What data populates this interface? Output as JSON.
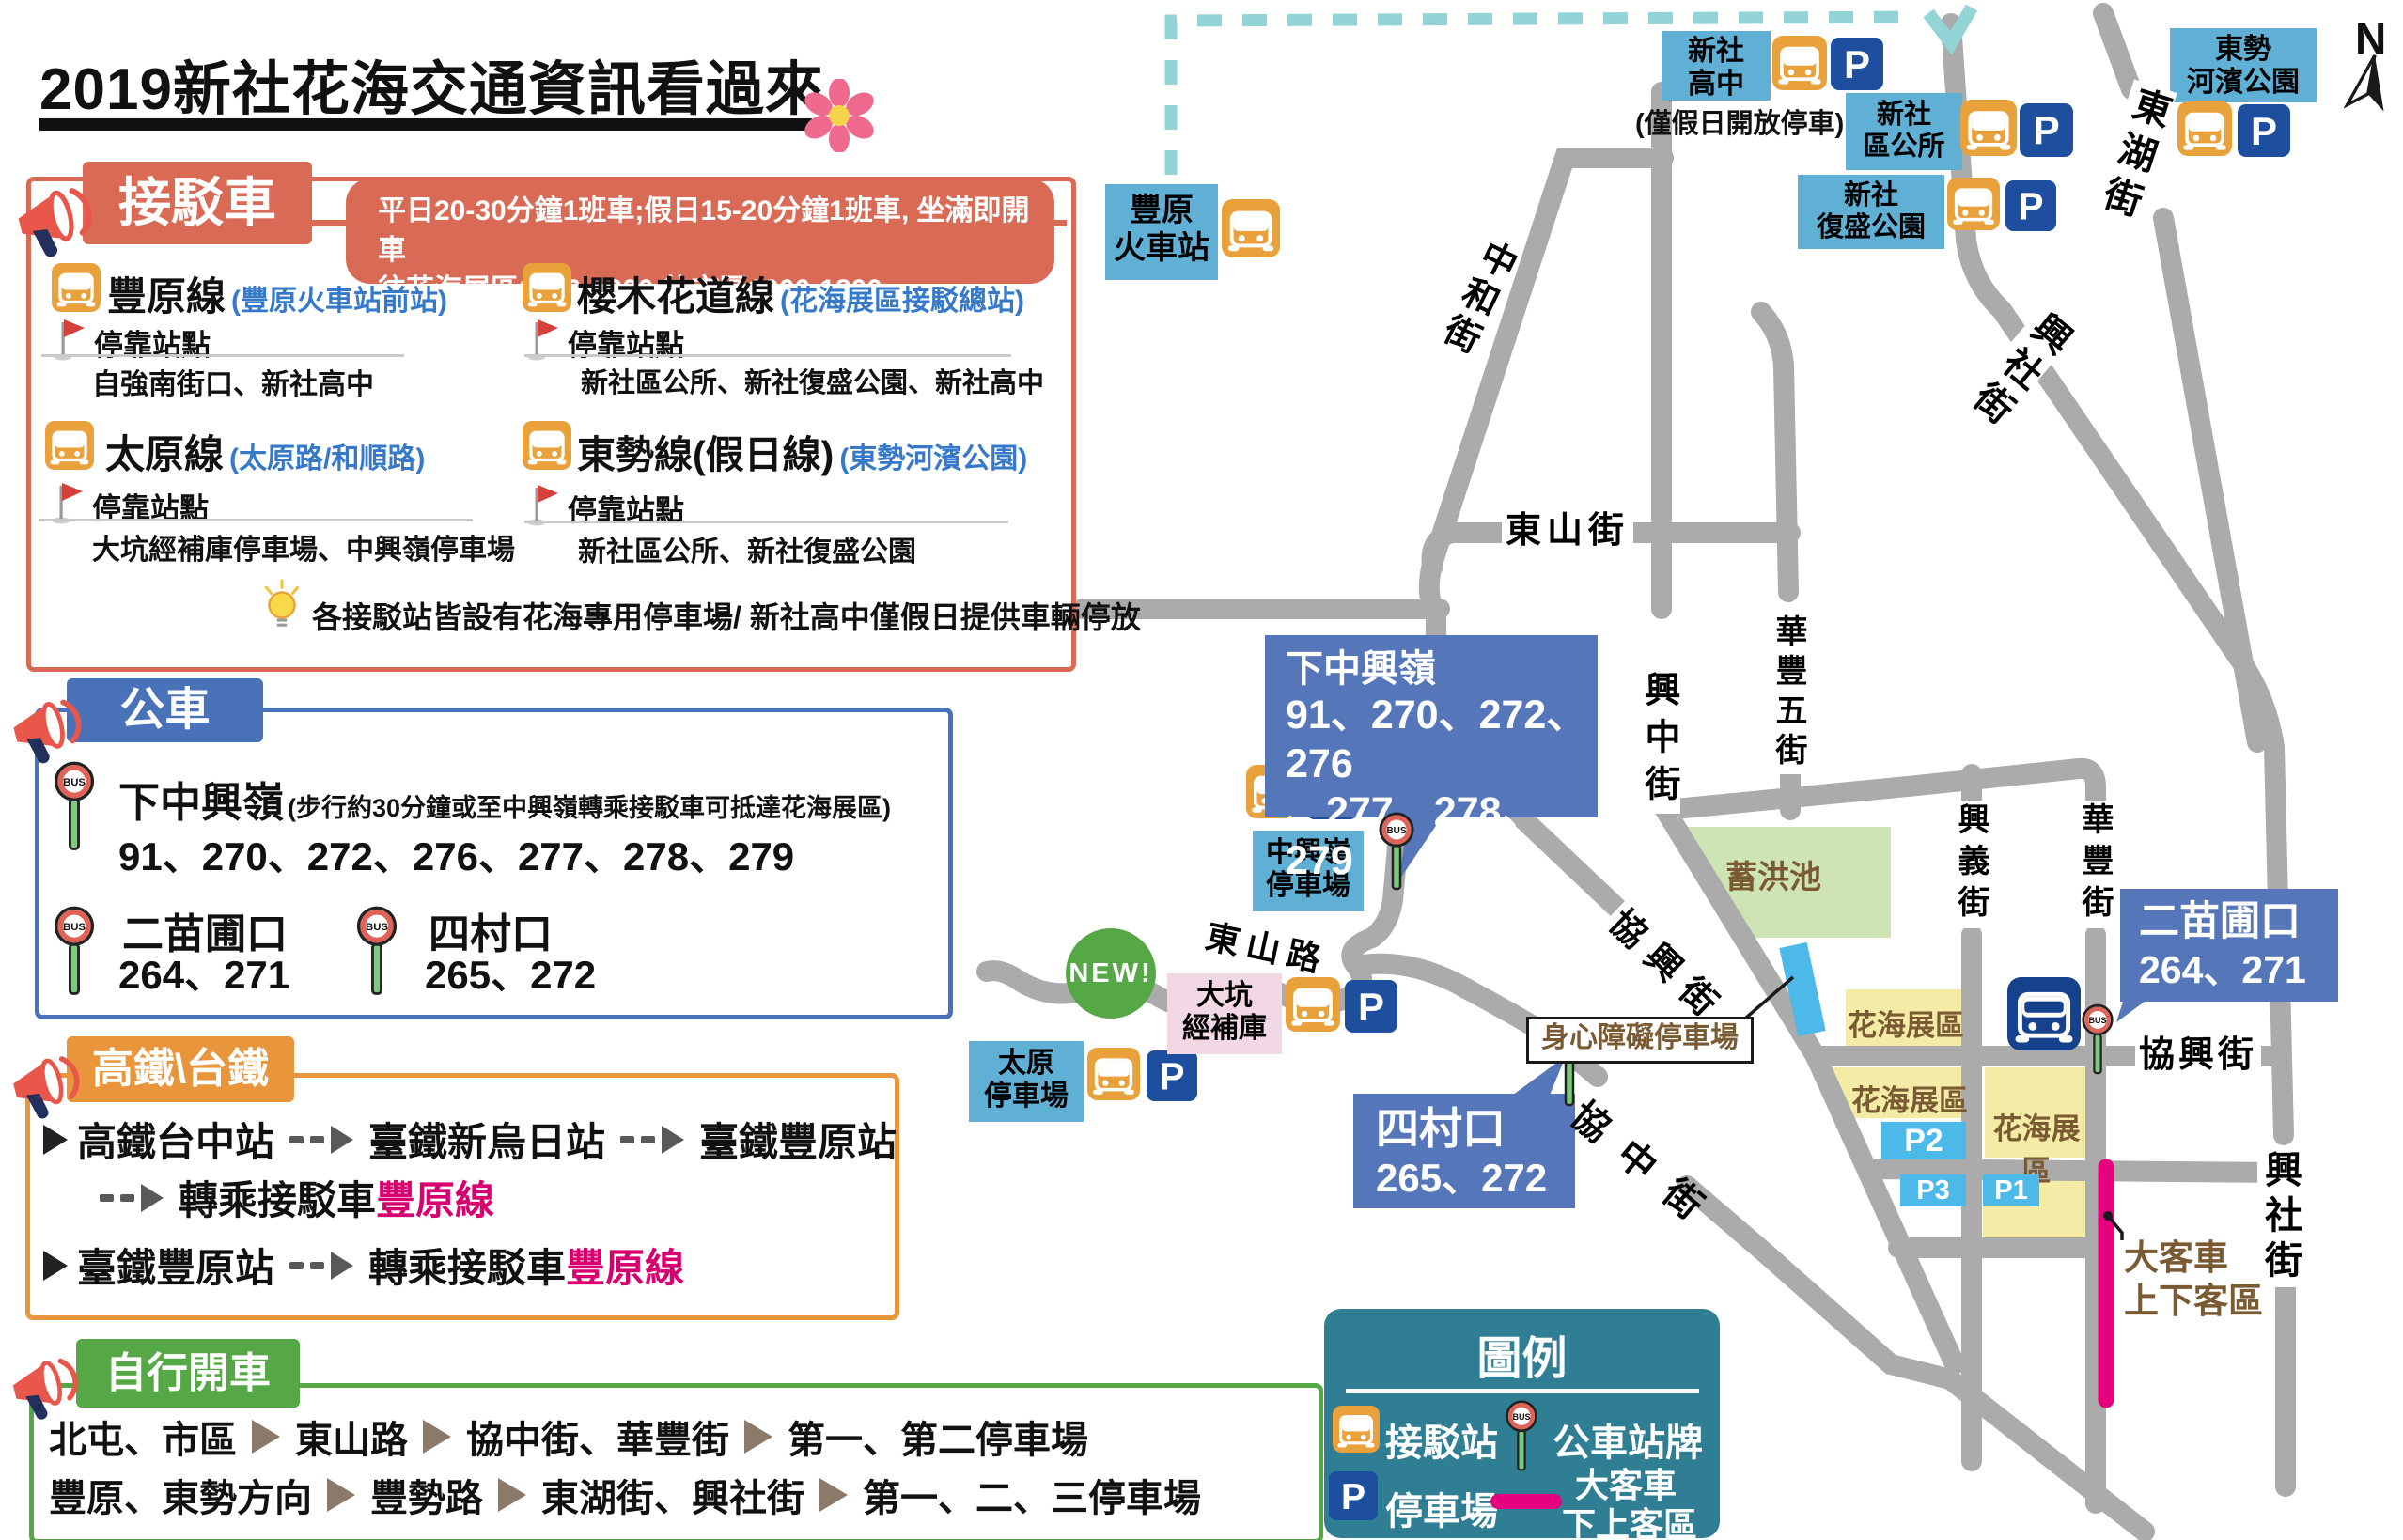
{
  "title": "2019新社花海交通資訊看過來",
  "colors": {
    "accent_red": "#d96a55",
    "panel_blue": "#4a72b8",
    "station_blue": "#5fb0d4",
    "orange": "#e8953b",
    "green": "#55a845",
    "legend_teal": "#2f7e93",
    "magenta": "#e5007e",
    "road_grey": "#ababab",
    "route_dash_teal": "#93d4d6",
    "bus_icon_orange": "#e9a23b",
    "parking_navy": "#1d4f9e",
    "expo_yellow": "#f4eba6",
    "p_cyan": "#4cb9e8",
    "pond_green": "#cfe4b4",
    "text_brown": "#7a5a33"
  },
  "panels": {
    "shuttle": {
      "header": "接駁車",
      "note_line1": "平日20-30分鐘1班車;假日15-20分鐘1班車, 坐滿即開車",
      "note_line2": "往花海展區0800-1600;往市區1000-1800",
      "stops_label": "停靠站點",
      "routes": [
        {
          "name": "豐原線",
          "sub": "(豐原火車站前站)",
          "stops": "自強南街口、新社高中"
        },
        {
          "name": "櫻木花道線",
          "sub": "(花海展區接駁總站)",
          "stops": "新社區公所、新社復盛公園、新社高中"
        },
        {
          "name": "太原線",
          "sub": "(太原路/和順路)",
          "stops": "大坑經補庫停車場、中興嶺停車場"
        },
        {
          "name": "東勢線(假日線)",
          "sub": "(東勢河濱公園)",
          "stops": "新社區公所、新社復盛公園"
        }
      ],
      "tip": "各接駁站皆設有花海專用停車場/ 新社高中僅假日提供車輛停放"
    },
    "bus": {
      "header": "公車",
      "entries": [
        {
          "name": "下中興嶺",
          "sub": "(步行約30分鐘或至中興嶺轉乘接駁車可抵達花海展區)",
          "routes": "91、270、272、276、277、278、279"
        },
        {
          "name": "二苗圃口",
          "routes": "264、271"
        },
        {
          "name": "四村口",
          "routes": "265、272"
        }
      ]
    },
    "rail": {
      "header": "高鐵\\台鐵",
      "r1a": "高鐵台中站",
      "r1b": "臺鐵新烏日站",
      "r1c": "臺鐵豐原站",
      "transfer": "轉乘接駁車",
      "line": "豐原線",
      "r2a": "臺鐵豐原站"
    },
    "drive": {
      "header": "自行開車",
      "r1": [
        "北屯、市區",
        "東山路",
        "協中街、華豐街",
        "第一、第二停車場"
      ],
      "r2": [
        "豐原、東勢方向",
        "豐勢路",
        "東湖街、興社街",
        "第一、二、三停車場"
      ]
    }
  },
  "legend": {
    "header": "圖例",
    "shuttle": "接駁站",
    "busstop": "公車站牌",
    "parking": "停車場",
    "coach_l1": "大客車",
    "coach_l2": "下上客區"
  },
  "map": {
    "stations": {
      "fengyuan": {
        "l1": "豐原",
        "l2": "火車站"
      },
      "highschool": {
        "l1": "新社",
        "l2": "高中",
        "note": "(僅假日開放停車)"
      },
      "office": {
        "l1": "新社",
        "l2": "區公所"
      },
      "fusheng": {
        "l1": "新社",
        "l2": "復盛公園"
      },
      "dongshi": {
        "l1": "東勢",
        "l2": "河濱公園"
      },
      "zhongxingling": {
        "l1": "中興嶺",
        "l2": "停車場"
      },
      "taiyuan": {
        "l1": "太原",
        "l2": "停車場"
      },
      "dakeng": {
        "l1": "大坑",
        "l2": "經補庫"
      }
    },
    "callouts": {
      "xiazhongxingling": {
        "l1": "下中興嶺",
        "l2": "91、270、272、276",
        "l3": "、277、278、279"
      },
      "sicunkou": {
        "l1": "四村口",
        "l2": "265、272"
      },
      "ermiaopu": {
        "l1": "二苗圃口",
        "l2": "264、271"
      }
    },
    "streets": {
      "zhonghe": "中和街",
      "dongshan_st": "東山街",
      "xingzhong": "興中街",
      "huafengwu": "華豐五街",
      "xiexing_diag": "協興街",
      "xiexing_h": "協興街",
      "xingyi": "興義街",
      "huafeng": "華豐街",
      "donghu": "東湖街",
      "xingshe_up": "興社街",
      "xingshe_low": "興社街",
      "xiezhong": "協中街",
      "dongshan_rd": "東山路"
    },
    "areas": {
      "pond": "蓄洪池",
      "expo": "花海展區",
      "p1": "P1",
      "p2": "P2",
      "p3": "P3"
    },
    "labels": {
      "disabled": "身心障礙停車場",
      "coach_l1": "大客車",
      "coach_l2": "上下客區",
      "new_badge": "NEW!",
      "compass": "N"
    }
  }
}
